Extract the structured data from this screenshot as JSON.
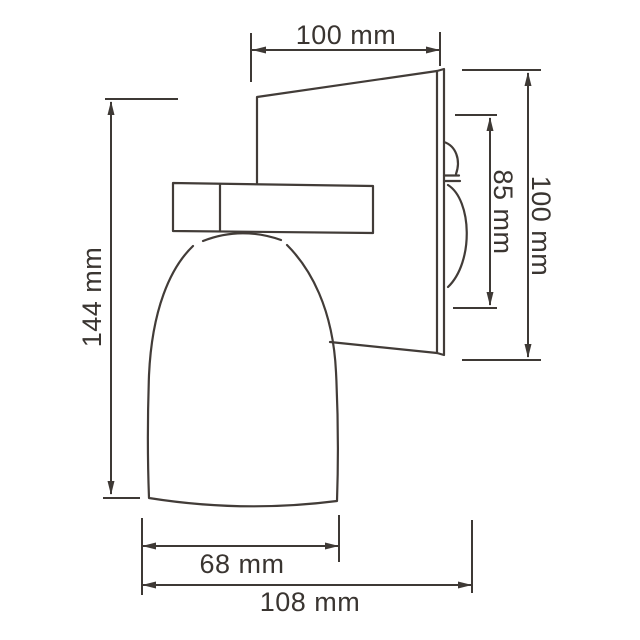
{
  "drawing": {
    "kind": "wall-lamp-side-view-dimension-drawing",
    "background_color": "#ffffff",
    "line_color": "#3e3935",
    "text_color": "#3a3531"
  },
  "dimensions": {
    "top_width": {
      "label": "100 mm",
      "value": 100,
      "unit": "mm"
    },
    "overall_height": {
      "label": "144 mm",
      "value": 144,
      "unit": "mm"
    },
    "backplate_inner": {
      "label": "85 mm",
      "value": 85,
      "unit": "mm"
    },
    "backplate_height": {
      "label": "100 mm",
      "value": 100,
      "unit": "mm"
    },
    "shade_width": {
      "label": "68 mm",
      "value": 68,
      "unit": "mm"
    },
    "overall_depth": {
      "label": "108 mm",
      "value": 108,
      "unit": "mm"
    }
  }
}
